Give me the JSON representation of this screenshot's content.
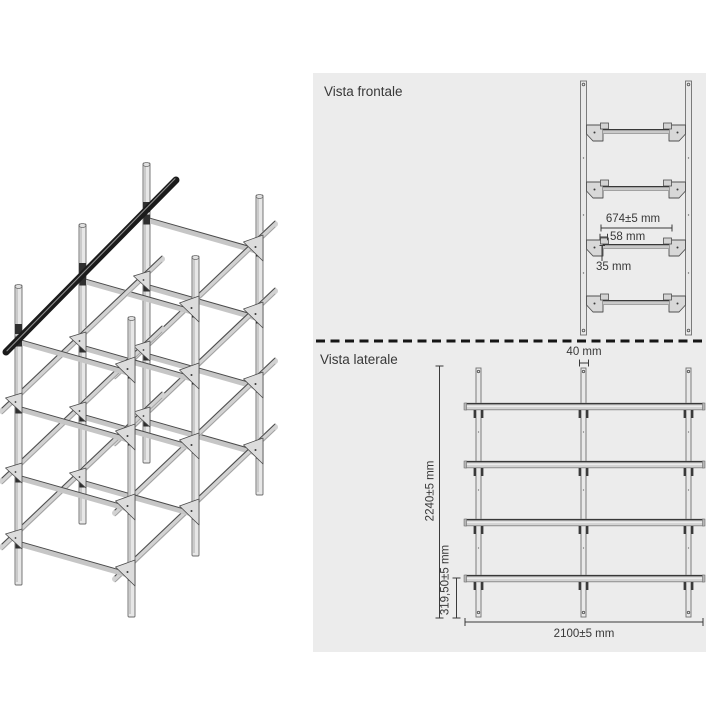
{
  "panel": {
    "bg_color": "#ececec",
    "front_view": {
      "title": "Vista frontale",
      "dimensions": {
        "beam_length": "674±5 mm",
        "hook_offset": "58 mm",
        "bracket_height": "35 mm"
      }
    },
    "side_view": {
      "title": "Vista laterale",
      "dimensions": {
        "post_width": "40 mm",
        "total_height": "2240±5 mm",
        "first_level_height": "319,50±5 mm",
        "total_length": "2100±5 mm"
      }
    }
  },
  "colors": {
    "line": "#3a3a3a",
    "text": "#383838",
    "metal_light": "#e7e7e7",
    "metal_mid": "#c9c9c9",
    "black_rail": "#1b1b1b"
  }
}
